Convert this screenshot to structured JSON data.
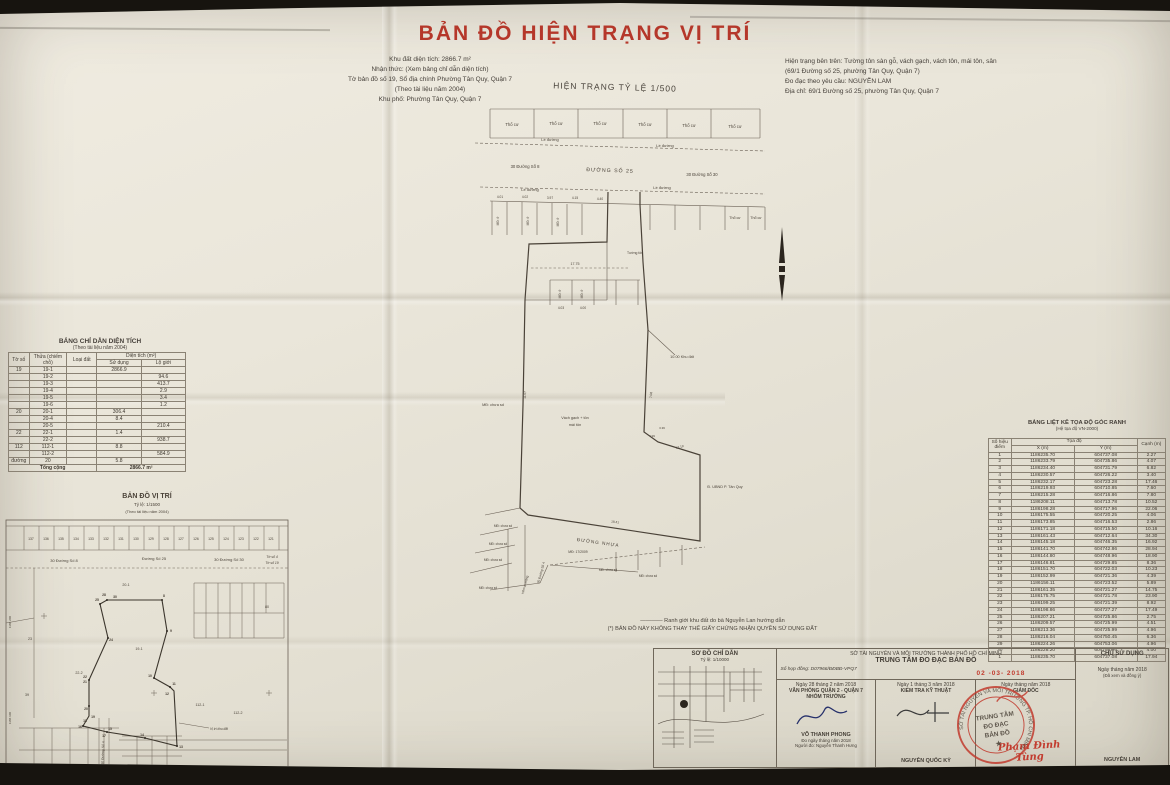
{
  "colors": {
    "title_red": "#b5372a",
    "stamp_red": "#c23b2e",
    "paper": "#e8e4d8",
    "ink": "#3f3930"
  },
  "title": "BẢN ĐỒ HIỆN TRẠNG VỊ TRÍ",
  "header": {
    "left_info": [
      "Khu đất diện tích: 2866.7 m²",
      "Nhận thức: (Xem bảng chỉ dẫn diện tích)",
      "Tờ bản đồ số 19, Sổ địa chính Phường Tân Quy, Quận 7",
      "(Theo tài liệu năm 2004)",
      "Khu phố: Phường Tân Quy, Quận 7"
    ],
    "scale_label": "HIỆN TRẠNG TỶ LỆ 1/500",
    "right_info": [
      "Hiện trạng bên trên: Tường tôn sàn gỗ, vách gạch, vách tôn, mái tôn, sân",
      "(69/1 Đường số 25, phường Tân Quy, Quận 7)",
      "Đo đạc theo yêu cầu: NGUYỄN LAM",
      "Địa chỉ: 69/1 Đường số 25, phường Tân Quy, Quận 7"
    ]
  },
  "main_map": {
    "lot_label": "Thổ cư",
    "le_duong": "Lề đường",
    "road8": "30 Đường Số 8",
    "road25": "ĐƯỜNG SỐ 25",
    "road30": "30 Đường Số 30",
    "tuong_ton": "Tường tôn",
    "md_chua_sd": "MĐ: chưa sd",
    "md_o": "MĐ: ở",
    "vach1": "Vách gạch + tôn",
    "vach2": "mái tôn",
    "khu_dat": "10.00 Khu đất",
    "ubnd": "Đ. UBND P. Tân Quy",
    "duong_nhua": "ĐƯỜNG NHỰA",
    "md_2009": "MĐ: 17/2009",
    "hem": "Hẻm xi măng",
    "road4": "30 Đường Số 4",
    "dims": [
      "4.01",
      "4.02",
      "3.97",
      "4.15",
      "4.40",
      "4.03",
      "4.00"
    ],
    "dim_17_75": "17.75",
    "dim_7_08": "7.08",
    "dim_12_19": "12.19",
    "dim_18_41": "18.41",
    "dim_11_07": "11.07",
    "dim_4_99": "4.99",
    "dim_3_36": "3.36"
  },
  "area_table": {
    "title": "BẢNG CHỈ DẪN DIỆN TÍCH",
    "subtitle": "(Theo tài liệu năm 2004)",
    "col_to": "Tờ số",
    "col_thua": "Thửa (chiếm chỗ)",
    "col_loai": "Loại đất",
    "col_dt": "Diện tích (m²)",
    "col_sd": "Sử dụng",
    "col_lg": "Lộ giới",
    "rows": [
      [
        "19",
        "19-1",
        "",
        "2866.9",
        ""
      ],
      [
        "",
        "19-2",
        "",
        "",
        "94.6"
      ],
      [
        "",
        "19-3",
        "",
        "",
        "413.7"
      ],
      [
        "",
        "19-4",
        "",
        "",
        "2.9"
      ],
      [
        "",
        "19-5",
        "",
        "",
        "3.4"
      ],
      [
        "",
        "19-6",
        "",
        "",
        "1.2"
      ],
      [
        "20",
        "20-1",
        "",
        "306.4",
        ""
      ],
      [
        "",
        "20-4",
        "",
        "8.4",
        ""
      ],
      [
        "",
        "20-5",
        "",
        "",
        "210.4"
      ],
      [
        "22",
        "22-1",
        "",
        "1.4",
        ""
      ],
      [
        "",
        "22-2",
        "",
        "",
        "938.7"
      ],
      [
        "112",
        "112-1",
        "",
        "8.8",
        ""
      ],
      [
        "",
        "112-2",
        "",
        "",
        "584.9"
      ],
      [
        "đường",
        "20",
        "",
        "5.8",
        ""
      ]
    ],
    "total_label": "Tổng cộng",
    "total_value": "2866.7 m²"
  },
  "location_map": {
    "title": "BẢN ĐỒ VỊ TRÍ",
    "scale": "Tỷ lệ: 1/1500",
    "source": "(Theo tài liệu năm 2004)",
    "road8": "30 Đường Số 8",
    "road25": "Đường Số 25",
    "road30": "30 Đường Số 30",
    "to4": "Tờ số 4",
    "to19": "Tờ số 19",
    "road4": "30 Đường Số 4",
    "strip_numbers": [
      "137",
      "136",
      "135",
      "134",
      "133",
      "132",
      "131",
      "130",
      "129",
      "128",
      "127",
      "126",
      "125",
      "124",
      "123",
      "122",
      "121"
    ],
    "grid_x1": "1186 200",
    "grid_x2": "1186 100",
    "grid_y1": "604 650",
    "grid_y2": "604 700",
    "grid_y3": "604 750",
    "lots": {
      "l20_1": "20-1",
      "l19_1": "19-1",
      "l22_2": "22-2",
      "l23": "23",
      "l39": "39",
      "l112_1": "112-1",
      "l112_2": "112-2",
      "l80": "80"
    },
    "pts": {
      "p8": "8",
      "p9": "9",
      "p10": "10",
      "p11": "11",
      "p12": "12",
      "p13": "13",
      "p14": "14",
      "p15": "15",
      "p16": "16",
      "p17": "17",
      "p18": "18",
      "p19": "19",
      "p20": "20",
      "p21": "21",
      "p22": "22",
      "p24": "24",
      "p25": "25",
      "p28": "28",
      "p30": "30"
    },
    "vitri": "Vị trí khu đất"
  },
  "coord_table": {
    "title": "BẢNG LIỆT KÊ TỌA ĐỘ GÓC RANH",
    "subtitle": "(Hệ tọa độ VN-2000)",
    "col_pt": "Số hiệu điểm",
    "col_coord": "Tọa độ",
    "col_x": "X (m)",
    "col_y": "Y (m)",
    "col_edge": "Cạnh (m)",
    "rows": [
      [
        "1",
        "1186235.70",
        "604737.08",
        "2.27"
      ],
      [
        "2",
        "1186233.79",
        "604735.86",
        "4.07"
      ],
      [
        "3",
        "1186234.40",
        "604731.79",
        "6.82"
      ],
      [
        "4",
        "1186230.57",
        "604726.22",
        "3.40"
      ],
      [
        "5",
        "1186232.17",
        "604723.28",
        "17.46"
      ],
      [
        "6",
        "1186219.93",
        "604710.85",
        "7.60"
      ],
      [
        "7",
        "1186215.28",
        "604716.86",
        "7.80"
      ],
      [
        "8",
        "1186208.11",
        "604713.78",
        "10.52"
      ],
      [
        "9",
        "1186198.28",
        "604717.96",
        "22.06"
      ],
      [
        "10",
        "1186175.55",
        "604720.25",
        "4.06"
      ],
      [
        "11",
        "1186173.85",
        "604716.53",
        "2.86"
      ],
      [
        "12",
        "1186171.18",
        "604715.50",
        "10.16"
      ],
      [
        "13",
        "1186161.43",
        "604712.64",
        "34.30"
      ],
      [
        "14",
        "1186145.18",
        "604746.35",
        "16.92"
      ],
      [
        "15",
        "1186141.70",
        "604742.86",
        "28.94"
      ],
      [
        "16",
        "1186144.80",
        "604748.96",
        "18.90"
      ],
      [
        "17",
        "1186146.81",
        "604729.85",
        "8.36"
      ],
      [
        "18",
        "1186151.70",
        "604722.03",
        "10.23"
      ],
      [
        "19",
        "1186152.99",
        "604721.36",
        "4.39"
      ],
      [
        "20",
        "1186156.11",
        "604723.52",
        "5.89"
      ],
      [
        "21",
        "1186161.35",
        "604721.27",
        "14.75"
      ],
      [
        "22",
        "1186175.75",
        "604721.78",
        "23.90"
      ],
      [
        "23",
        "1186199.25",
        "604721.39",
        "8.92"
      ],
      [
        "24",
        "1186198.86",
        "604727.27",
        "17.49"
      ],
      [
        "25",
        "1186207.21",
        "604725.86",
        "2.75"
      ],
      [
        "26",
        "1186209.57",
        "604725.99",
        "4.51"
      ],
      [
        "27",
        "1186213.36",
        "604725.99",
        "4.96"
      ],
      [
        "28",
        "1186216.04",
        "604750.45",
        "6.36"
      ],
      [
        "29",
        "1186224.26",
        "604753.06",
        "4.96"
      ],
      [
        "30",
        "1186228.20",
        "604756.96",
        "4.00"
      ],
      [
        "1",
        "1186235.70",
        "604737.08",
        "17.94"
      ]
    ]
  },
  "notes": [
    "———— Ranh giới khu đất do bà Nguyễn Lan hướng dẫn",
    "(*) BẢN ĐỒ NÀY KHÔNG THAY THẾ GIẤY CHỨNG NHẬN QUYỀN SỬ DỤNG ĐẤT"
  ],
  "sign_block": {
    "left": {
      "title": "SƠ ĐỒ CHỈ DẪN",
      "scale": "Tỷ lệ: 1/10000"
    },
    "center": {
      "dept": "SỞ TÀI NGUYÊN VÀ MÔI TRƯỜNG THÀNH PHỐ HỒ CHÍ MINH",
      "org": "TRUNG TÂM ĐO ĐẠC BẢN ĐỒ",
      "contract": "Số hợp đồng: D07966/ĐĐBĐ-VPQ7",
      "date_stamp": "02 -03- 2018",
      "col1": {
        "date": "Ngày 28 tháng 2 năm 2018",
        "role1": "VĂN PHÒNG QUẬN 2 - QUẬN 7",
        "role2": "NHÓM TRƯỞNG",
        "name": "VÕ THANH PHONG",
        "extra1": "Đo ngày   tháng   năm 2018",
        "extra2": "Người đo: Nguyễn Thanh Hưng"
      },
      "col2": {
        "date": "Ngày 1 tháng 3 năm 2018",
        "role": "KIỂM TRA KỸ THUẬT",
        "name": "NGUYỄN QUỐC KỲ"
      },
      "col3": {
        "date": "Ngày    tháng    năm 2018",
        "role": "GIÁM ĐỐC",
        "signed": "Phạm Đình Tùng"
      }
    },
    "right": {
      "title": "CHỦ SỬ DỤNG",
      "date": "Ngày    tháng    năm 2018",
      "note": "(Đã xem và đồng ý)",
      "name": "NGUYỄN LAM"
    },
    "stamp": {
      "ring": "SỞ TÀI NGUYÊN VÀ MÔI TRƯỜNG TP. HỒ CHÍ MINH",
      "center1": "TRUNG TÂM",
      "center2": "ĐO ĐẠC",
      "center3": "BẢN ĐỒ"
    }
  }
}
